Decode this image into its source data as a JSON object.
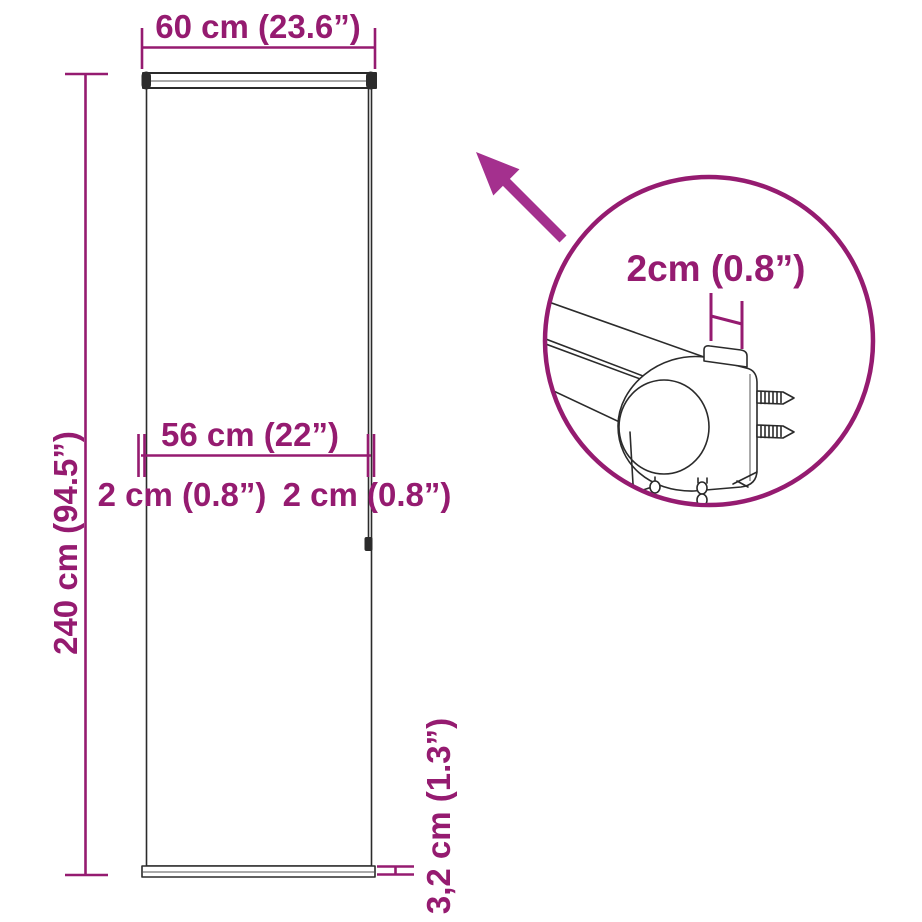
{
  "colors": {
    "dimension": "#951b70",
    "arrow": "#a4308e",
    "outline": "#2b2b2b"
  },
  "labels": {
    "top_width": "60 cm (23.6”)",
    "height": "240 cm (94.5”)",
    "bracket_span": "56 cm (22”)",
    "left_offset": "2 cm (0.8”)",
    "right_offset": "2 cm (0.8”)",
    "bottom_bar_height": "3,2 cm (1.3”)",
    "bracket_tab_width": "2cm (0.8”)"
  }
}
